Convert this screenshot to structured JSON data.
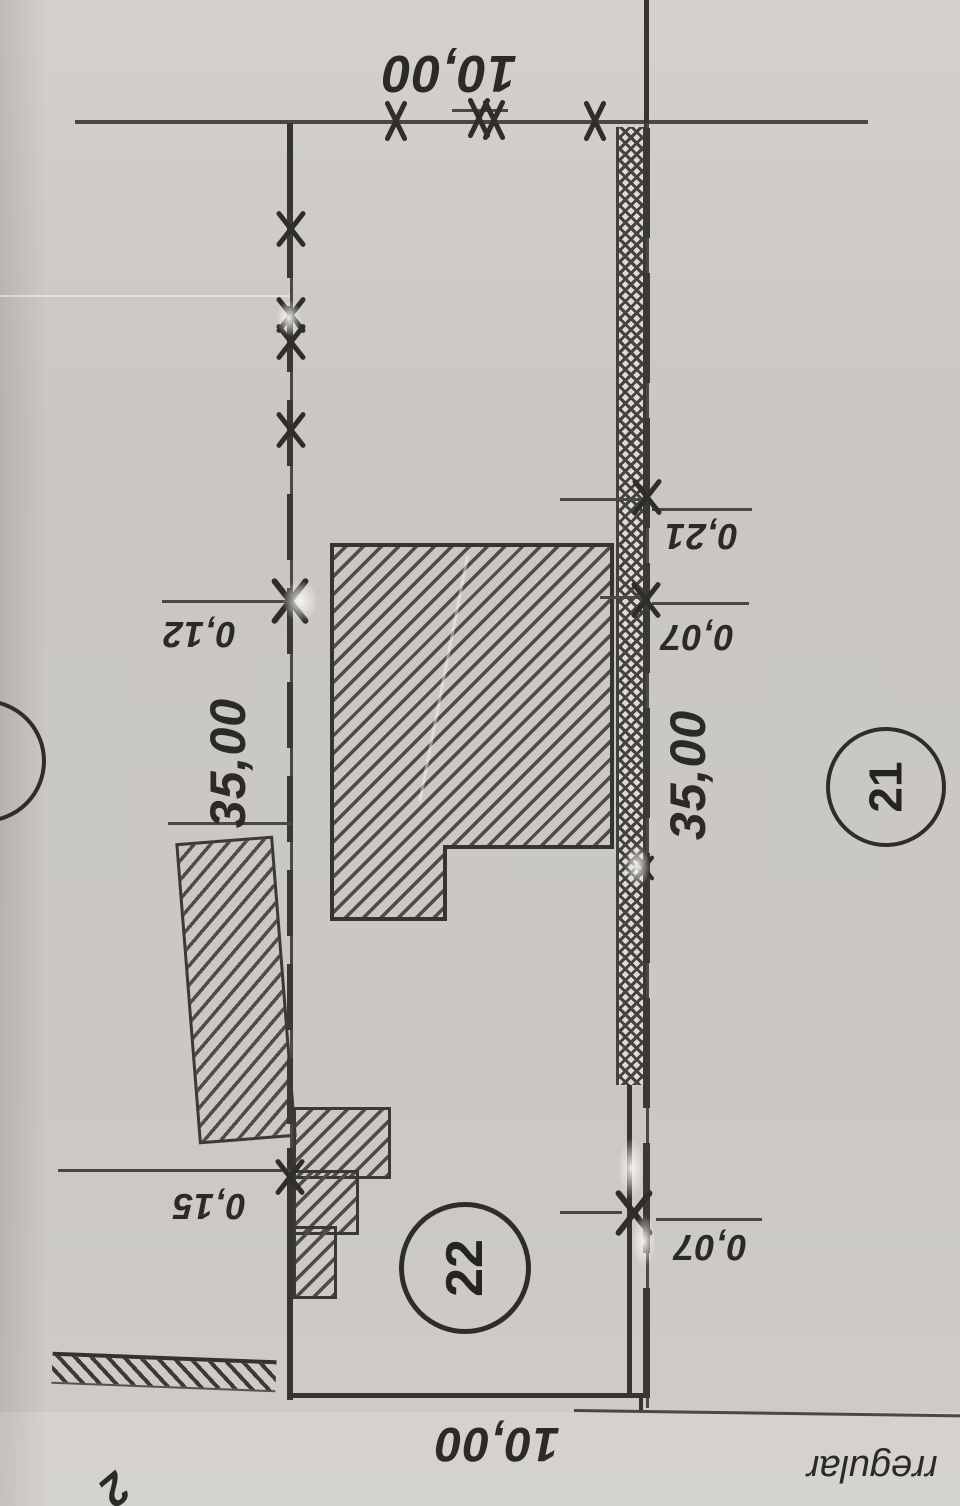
{
  "plan": {
    "dimensions": {
      "top_width": "10,00",
      "bottom_width": "10,00",
      "left_depth": "35,00",
      "right_depth": "35,00"
    },
    "offsets": {
      "left_upper": "0,12",
      "left_lower": "0,15",
      "right_upper": "0,21",
      "right_mid": "0,07",
      "right_lower": "0,07"
    },
    "parcels": {
      "right": "21",
      "center": "22",
      "left_partial": "23"
    },
    "annotations": {
      "bottom_text": "rregular",
      "bottom_left_digit": "2"
    },
    "colors": {
      "paper": "#cbc8c3",
      "ink": "#33312c"
    }
  }
}
